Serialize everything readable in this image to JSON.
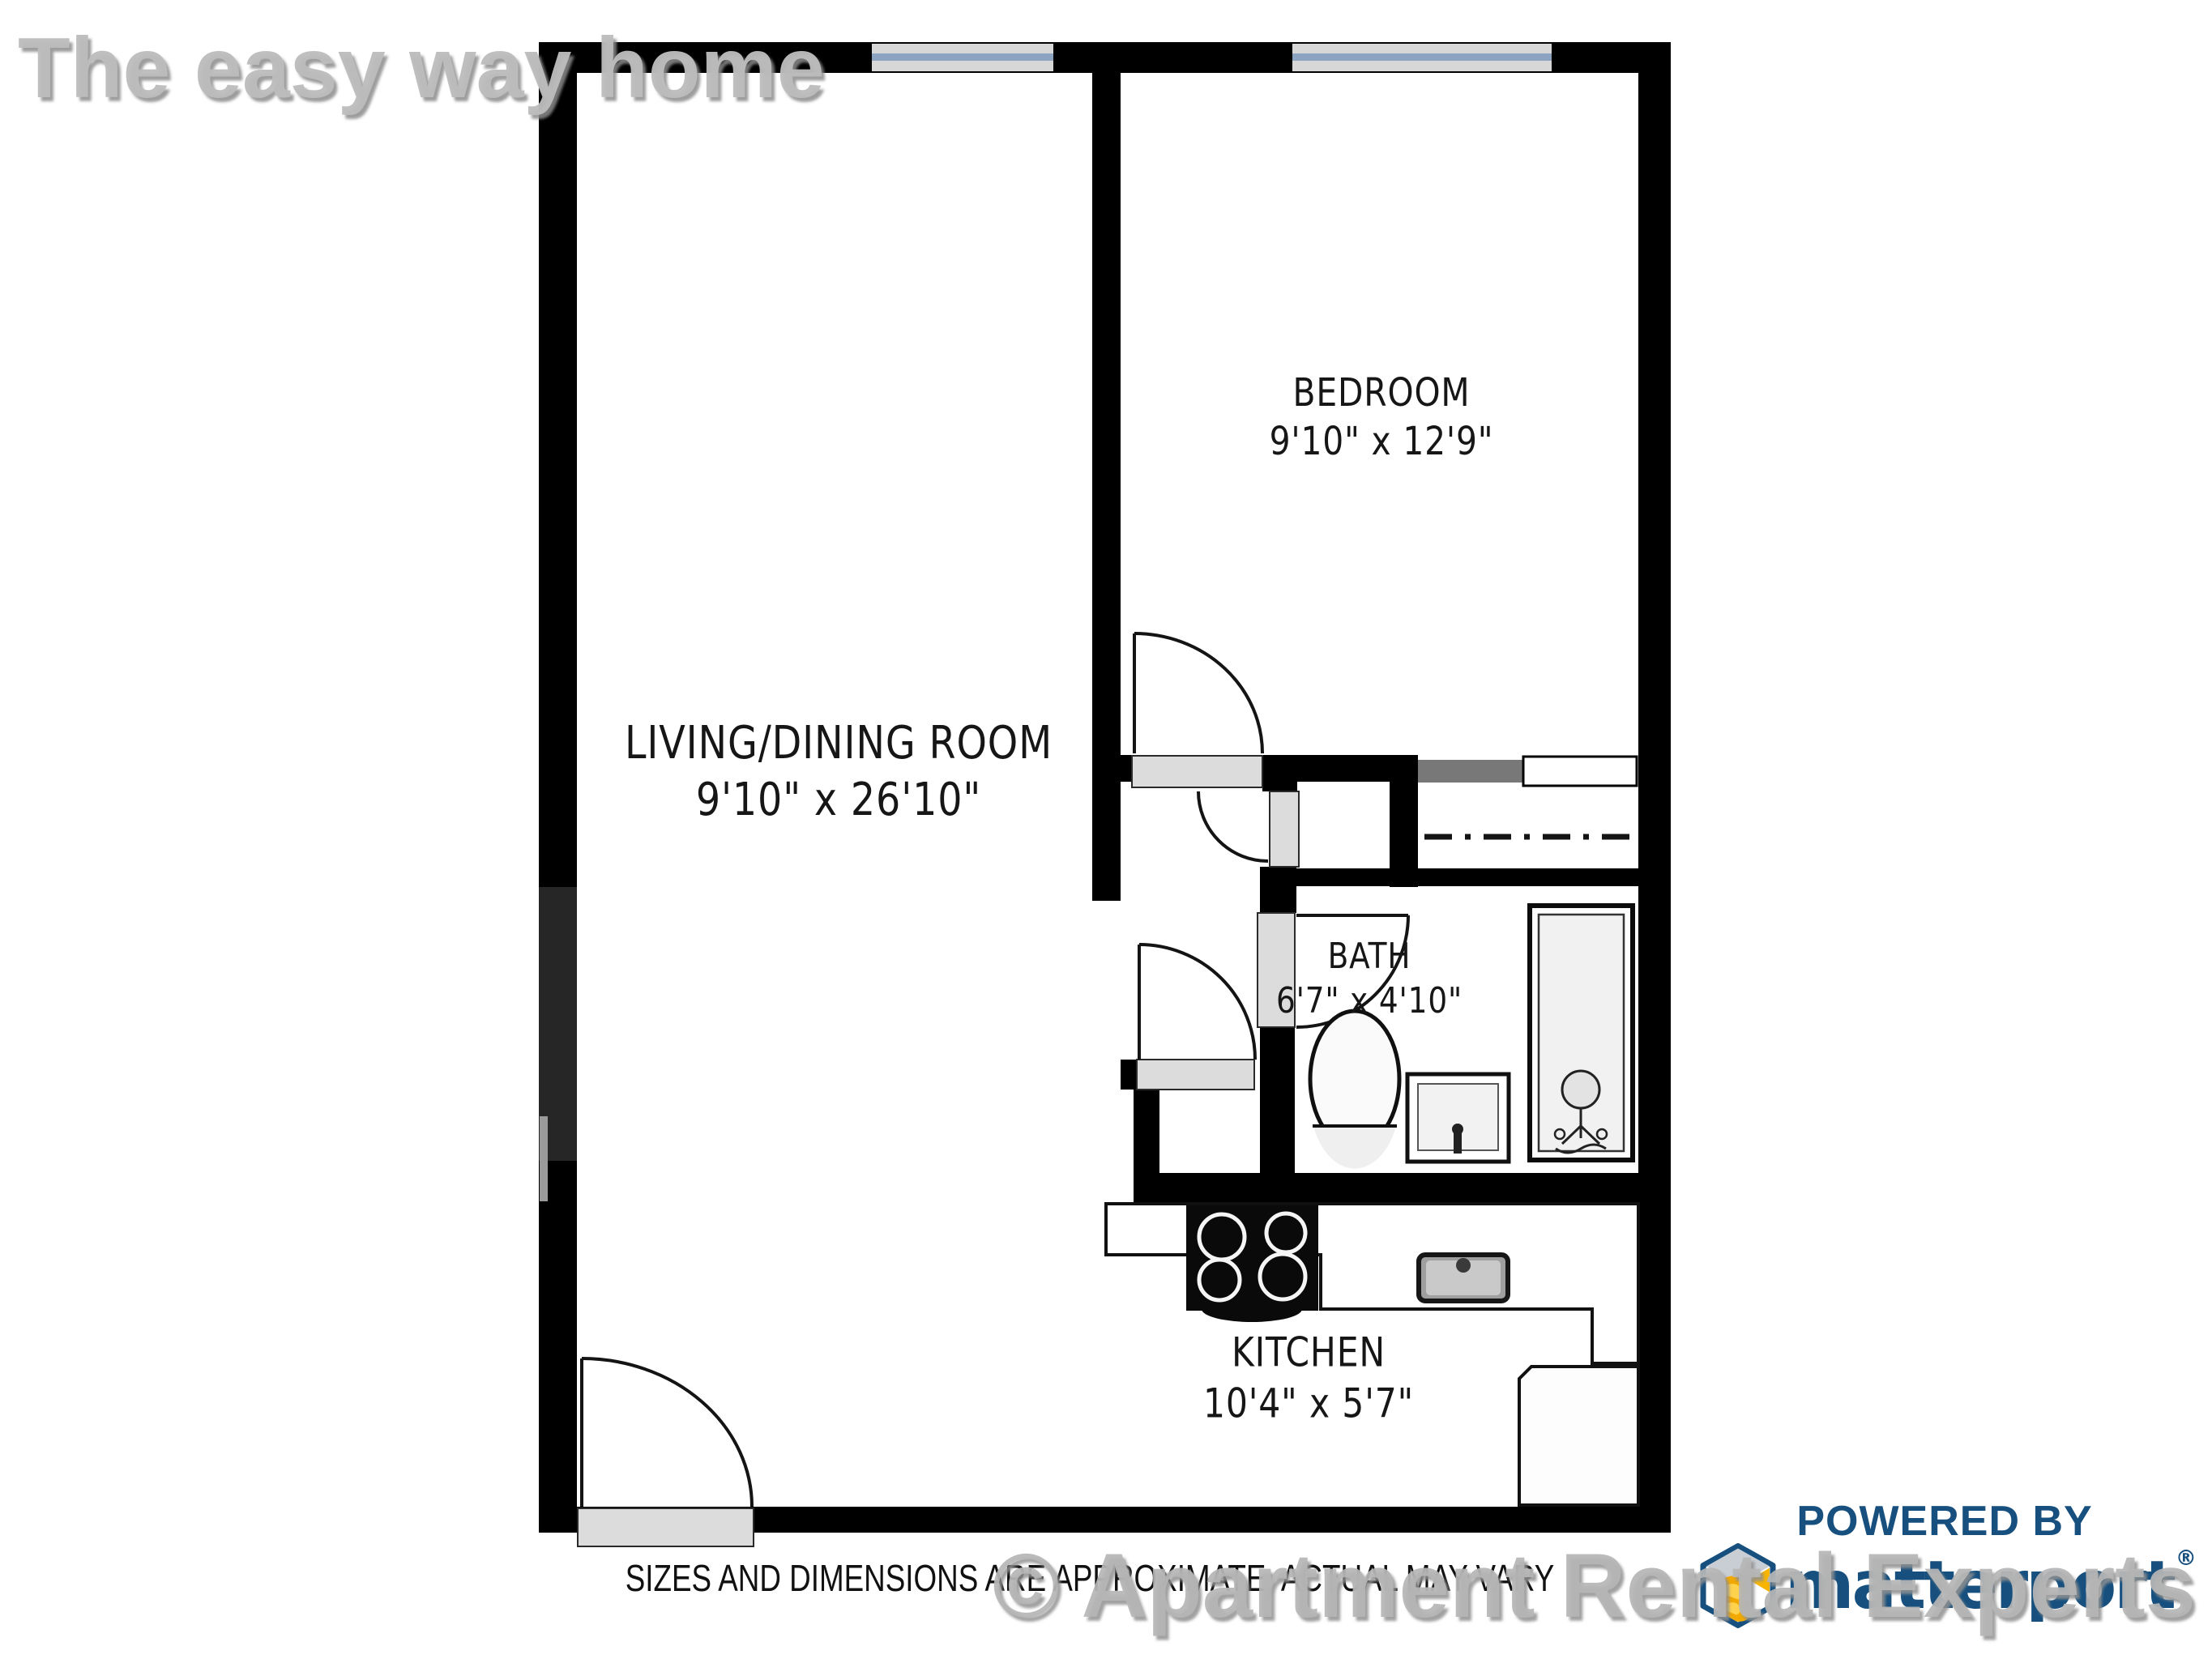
{
  "watermark_top": {
    "text": "The easy way home",
    "color": "#bcbcbc"
  },
  "floor_plan": {
    "rooms": [
      {
        "id": "bedroom",
        "name": "BEDROOM",
        "dims": "9'10\" x 12'9\""
      },
      {
        "id": "living_dining",
        "name": "LIVING/DINING ROOM",
        "dims": "9'10\" x 26'10\""
      },
      {
        "id": "bath",
        "name": "BATH",
        "dims": "6'7\" x 4'10\""
      },
      {
        "id": "kitchen",
        "name": "KITCHEN",
        "dims": "10'4\" x 5'7\""
      }
    ],
    "wall_color": "#000000",
    "sill_color": "#dcdcdc",
    "window_glass_color": "#8da3c2"
  },
  "disclaimer": {
    "text": "SIZES AND DIMENSIONS ARE APPROXIMATE, ACTUAL MAY VARY"
  },
  "watermark_bottom": {
    "text": "© Apartment Rental Experts",
    "color": "#b6b6b6"
  },
  "branding": {
    "powered_by": "POWERED BY",
    "brand": "matterport",
    "registered": "®",
    "navy": "#17507e",
    "yellow": "#f7b500"
  }
}
